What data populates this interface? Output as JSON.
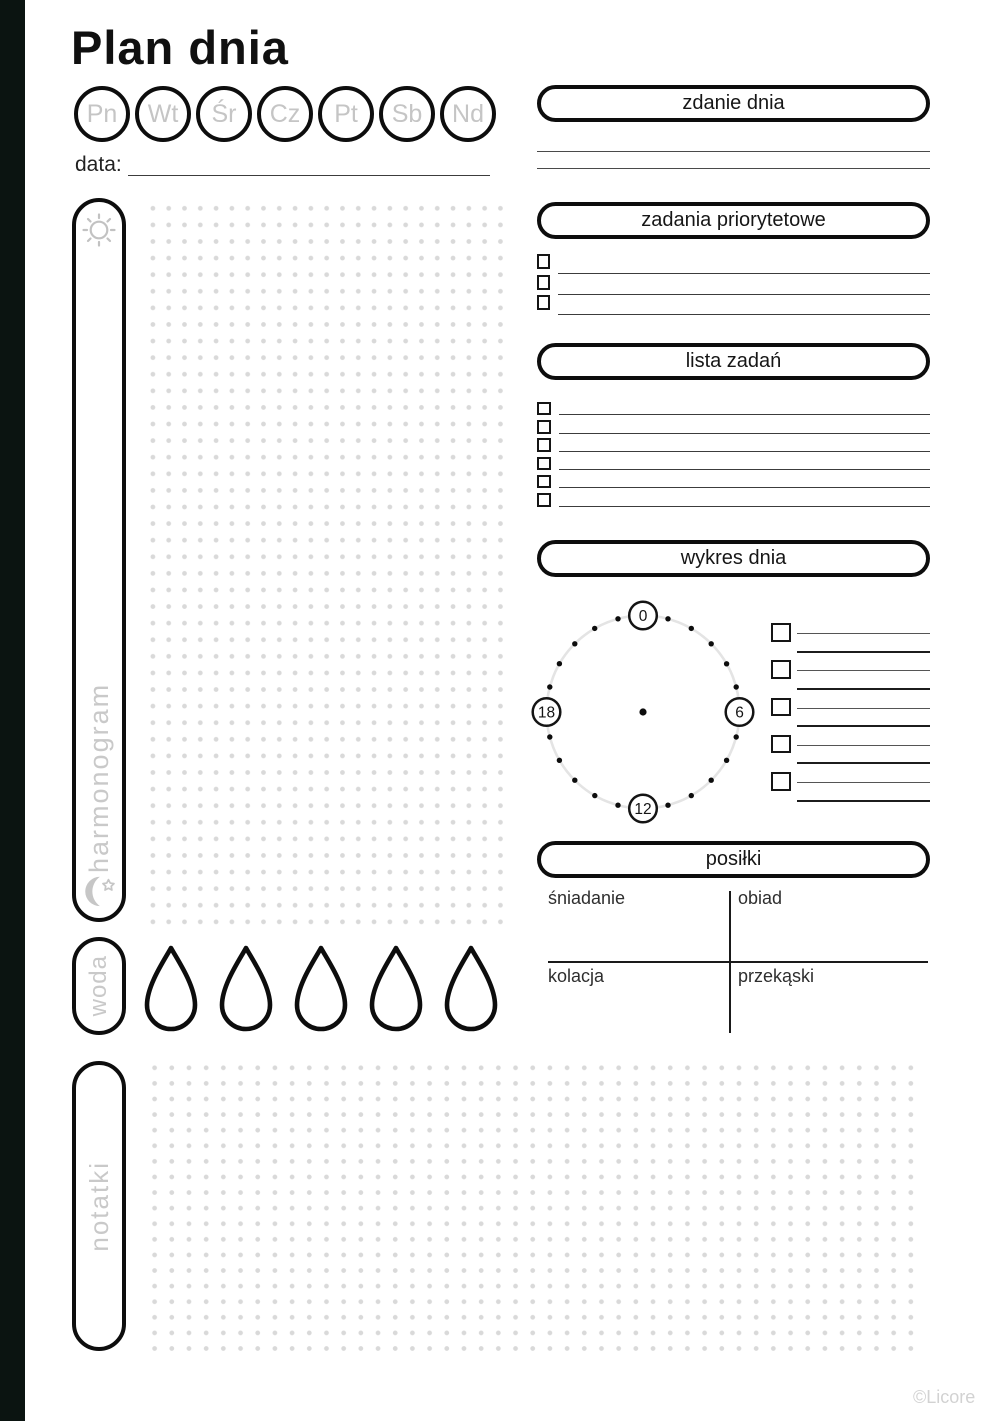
{
  "page": {
    "title": "Plan dnia",
    "date_label": "data:",
    "copyright": "©Licore"
  },
  "days": [
    "Pn",
    "Wt",
    "Śr",
    "Cz",
    "Pt",
    "Sb",
    "Nd"
  ],
  "schedule": {
    "label": "harmonogram",
    "top_icon": "sun-icon",
    "bottom_icon": "moon-star-icon"
  },
  "sentence": {
    "title": "zdanie dnia",
    "line_count": 2
  },
  "priority": {
    "title": "zadania priorytetowe",
    "row_count": 3
  },
  "tasks": {
    "title": "lista zadań",
    "row_count": 6
  },
  "day_chart": {
    "title": "wykres dnia",
    "hour_labels": [
      "0",
      "6",
      "12",
      "18"
    ],
    "hour_dot_count": 24,
    "legend_row_count": 5
  },
  "meals": {
    "title": "posiłki",
    "labels": {
      "top_left": "śniadanie",
      "top_right": "obiad",
      "bottom_left": "kolacja",
      "bottom_right": "przekąski"
    }
  },
  "water": {
    "label": "woda",
    "drop_count": 5
  },
  "notes": {
    "label": "notatki"
  },
  "colors": {
    "ink": "#0d0d0d",
    "edge_bar": "#0b1411",
    "muted_label": "#c9c9c9",
    "dot_grid": "#d9d9d9",
    "clock_ring": "#e4e4e4",
    "writing_line": "#3c3c3c"
  }
}
